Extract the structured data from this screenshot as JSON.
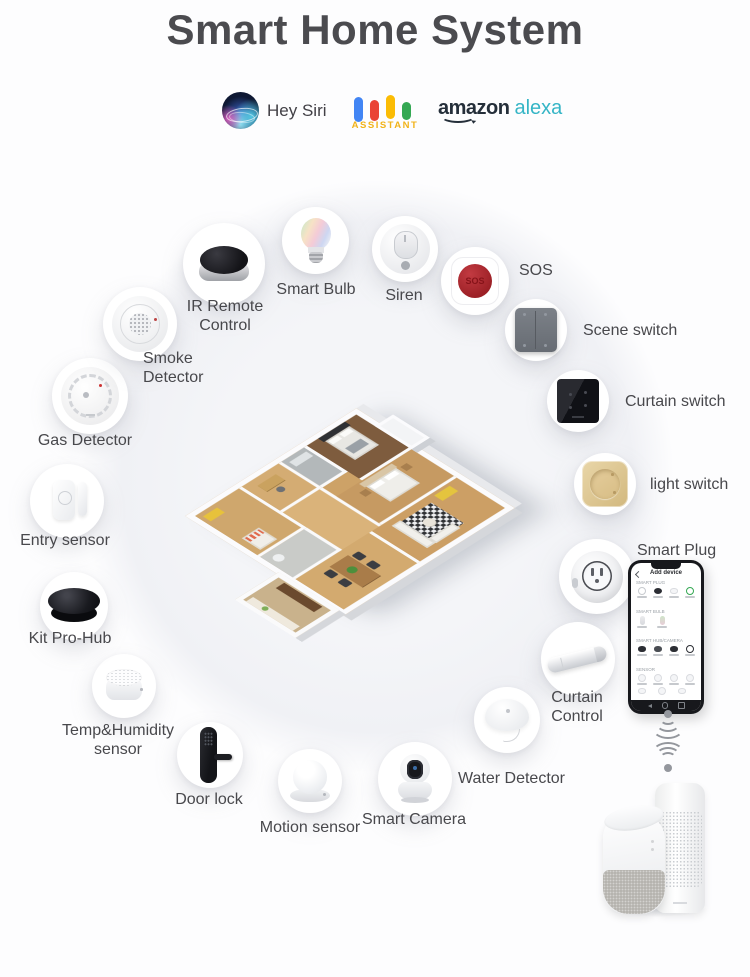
{
  "title": "Smart Home System",
  "assistants": {
    "siri": {
      "label": "Hey Siri"
    },
    "google": {
      "label": "ASSISTANT"
    },
    "alexa": {
      "brand": "amazon",
      "product": "alexa"
    }
  },
  "devices": [
    {
      "id": "ir-remote-control",
      "line1": "IR Remote",
      "line2": "Control"
    },
    {
      "id": "smart-bulb",
      "line1": "Smart Bulb"
    },
    {
      "id": "siren",
      "line1": "Siren"
    },
    {
      "id": "sos",
      "line1": "SOS",
      "button_text": "SOS"
    },
    {
      "id": "scene-switch",
      "line1": "Scene switch"
    },
    {
      "id": "curtain-switch",
      "line1": "Curtain switch"
    },
    {
      "id": "light-switch",
      "line1": "light switch"
    },
    {
      "id": "smart-plug",
      "line1": "Smart Plug"
    },
    {
      "id": "curtain-control",
      "line1": "Curtain",
      "line2": "Control"
    },
    {
      "id": "water-detector",
      "line1": "Water Detector"
    },
    {
      "id": "smart-camera",
      "line1": "Smart Camera"
    },
    {
      "id": "motion-sensor",
      "line1": "Motion sensor"
    },
    {
      "id": "door-lock",
      "line1": "Door lock"
    },
    {
      "id": "temp-humidity-sensor",
      "line1": "Temp&Humidity",
      "line2": "sensor"
    },
    {
      "id": "kit-pro-hub",
      "line1": "Kit Pro-Hub"
    },
    {
      "id": "entry-sensor",
      "line1": "Entry sensor"
    },
    {
      "id": "gas-detector",
      "line1": "Gas Detector"
    },
    {
      "id": "smoke-detector",
      "line1": "Smoke",
      "line2": "Detector"
    }
  ],
  "phone": {
    "header": "Add device",
    "sections": [
      {
        "title": "SMART PLUG"
      },
      {
        "title": "SMART BULB"
      },
      {
        "title": "SMART HUB/CAMERA"
      },
      {
        "title": "SENSOR"
      }
    ]
  },
  "colors": {
    "title_text": "#4b4b4f",
    "label_text": "#48484c",
    "google_blue": "#4285f4",
    "google_red": "#ea4335",
    "google_yellow": "#fbbc05",
    "google_green": "#34a853",
    "assistant_yellow": "#f1b31a",
    "alexa_teal": "#35b5c6",
    "amazon_dark": "#252f3a",
    "sos_red": "#9c2026",
    "light_switch_gold": "#d9c08e"
  }
}
